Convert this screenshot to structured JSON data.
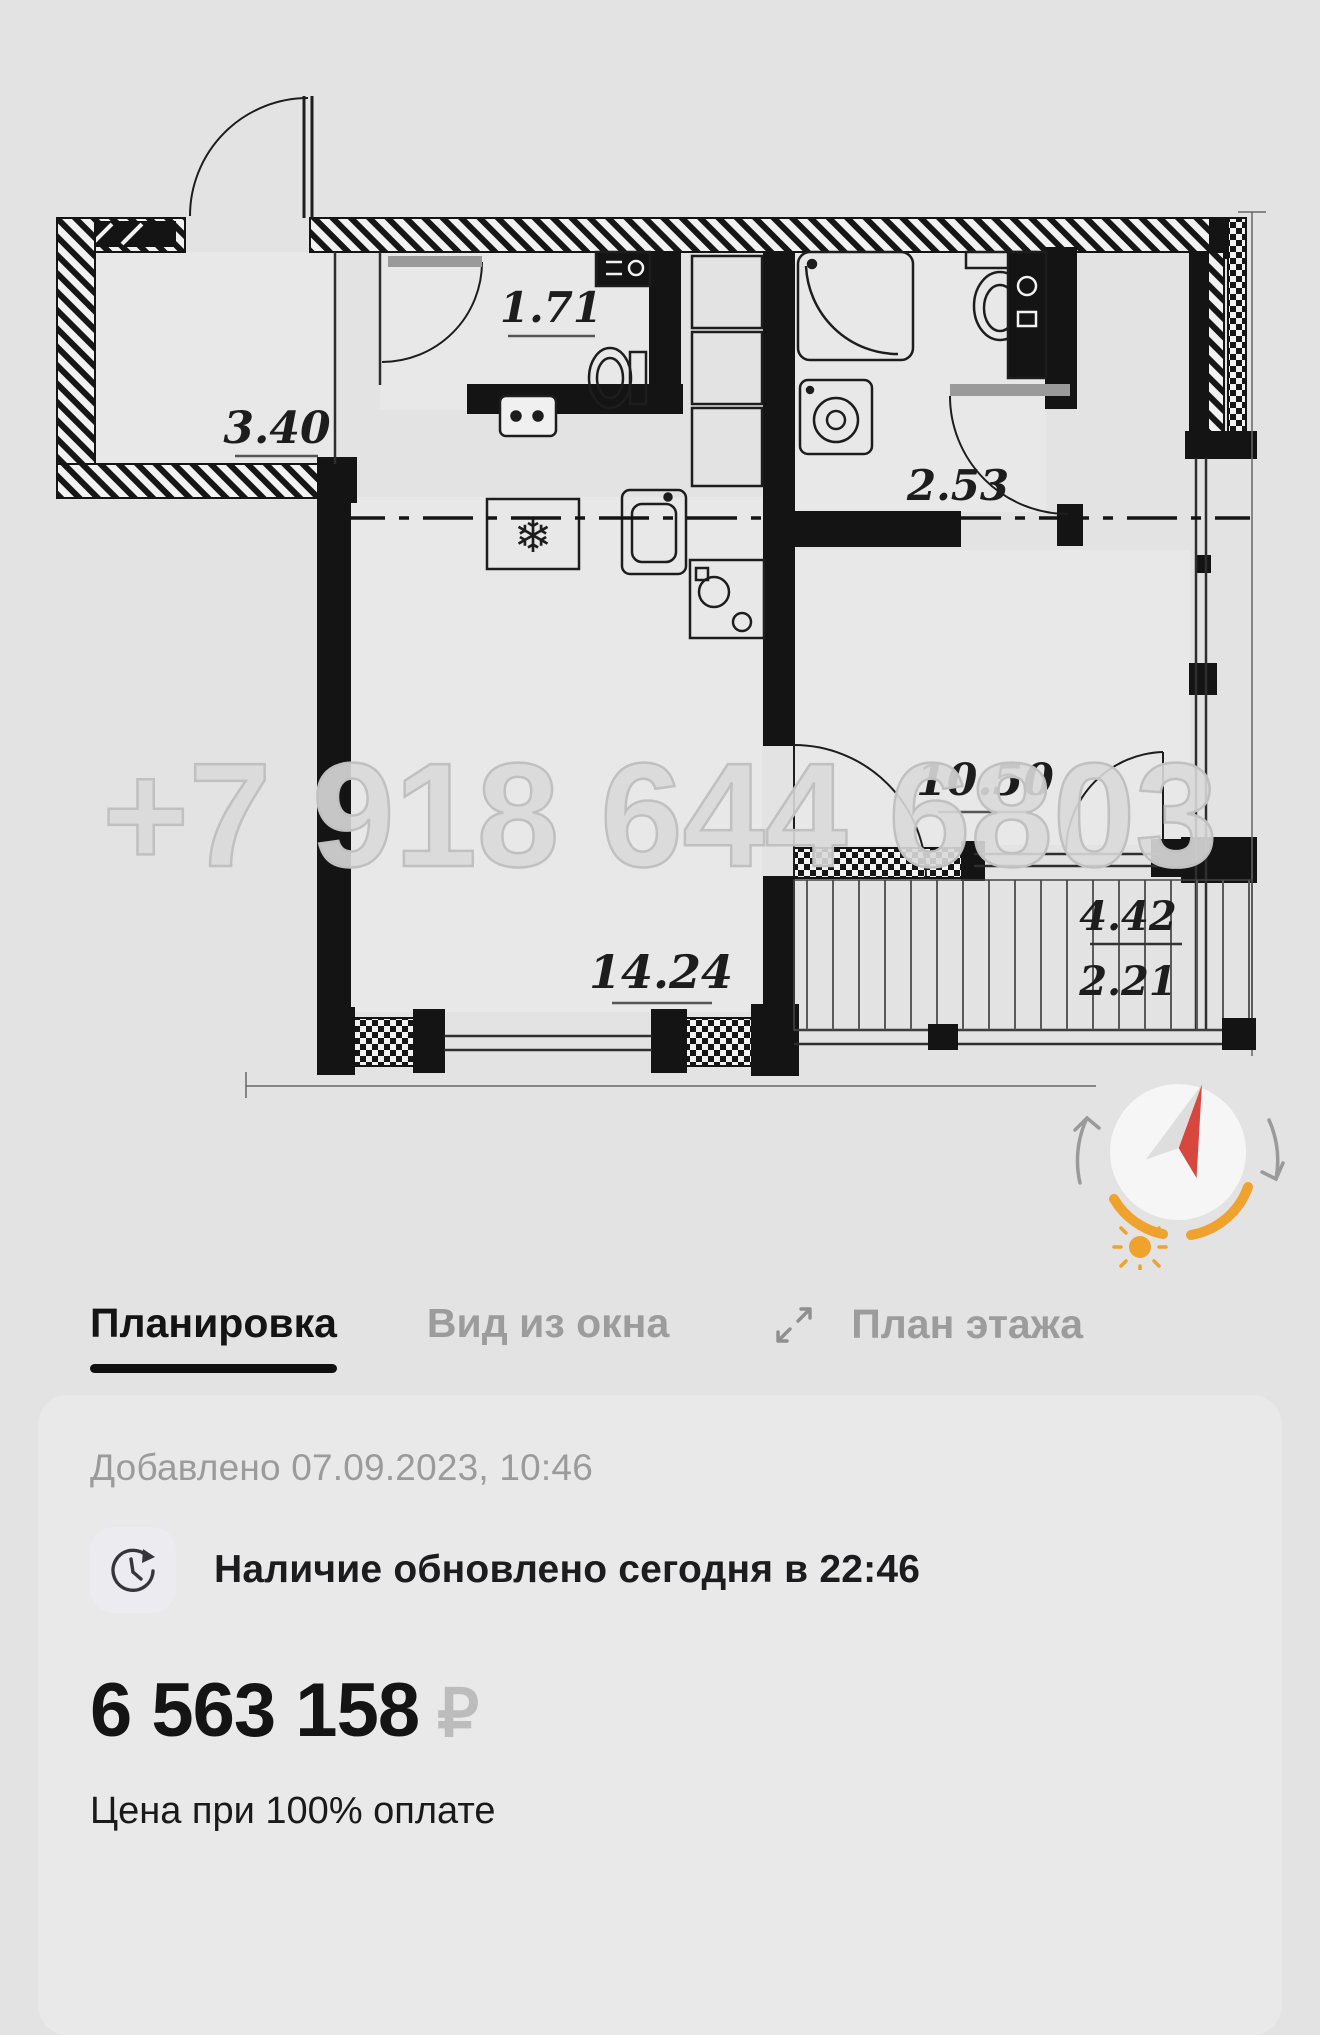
{
  "floor_plan": {
    "watermark": "+7 918 644 6803",
    "rooms": {
      "hallway": "3.40",
      "wc": "1.71",
      "bathroom": "2.53",
      "room": "10.50",
      "living_room": "14.24",
      "balcony_total": "4.42",
      "balcony_counted": "2.21"
    }
  },
  "tabs": {
    "layout": "Планировка",
    "window_view": "Вид из окна",
    "floor_plan": "План этажа"
  },
  "card": {
    "added": "Добавлено 07.09.2023, 10:46",
    "availability": "Наличие обновлено сегодня в 22:46",
    "price_amount": "6 563 158",
    "price_currency": "₽",
    "price_note": "Цена при 100% оплате"
  },
  "colors": {
    "page_bg": "#e3e3e3",
    "card_bg": "#e9e9e9",
    "active_text": "#141414",
    "muted_text": "#9b9b9b",
    "compass_orange": "#f0a22e",
    "compass_red": "#d8473e"
  }
}
